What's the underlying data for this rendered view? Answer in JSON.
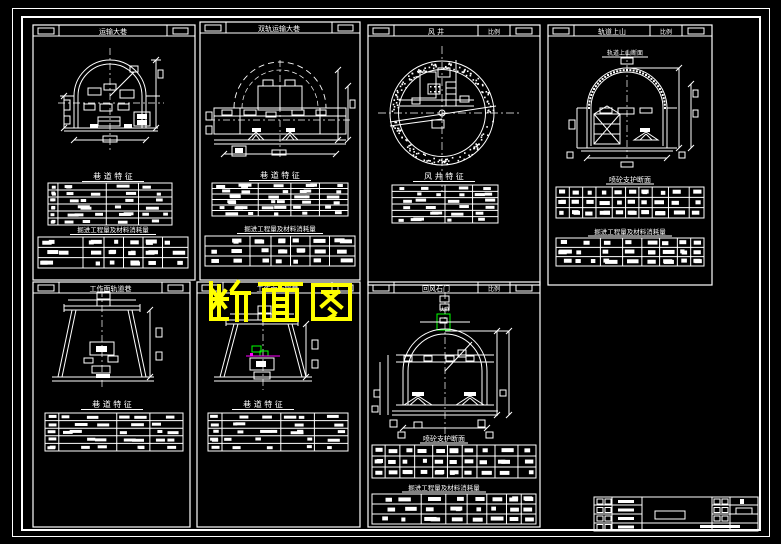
{
  "sheet": {
    "background_color": "#000000",
    "line_color": "#ffffff",
    "accent_green": "#00ff00",
    "accent_magenta": "#ff00ff"
  },
  "watermark": {
    "text": "断面图",
    "color": "#ffff00"
  },
  "panels": [
    {
      "title": "运输大巷",
      "char_table_heading": "巷 道 特 征",
      "qty_table_heading": "掘进工程量及材料消耗量"
    },
    {
      "title": "双轨运输大巷",
      "char_table_heading": "巷 道 特 征",
      "qty_table_heading": "掘进工程量及材料消耗量"
    },
    {
      "title": "风 井",
      "scale_label": "比例",
      "char_table_heading": "风 井 特 征"
    },
    {
      "title": "轨道上山",
      "scale_label": "比例",
      "section_subtitle": "轨道上山断面",
      "char_table_heading": "喷砼支护断面",
      "qty_table_heading": "掘进工程量及材料消耗量"
    },
    {
      "title": "工作面轨道巷",
      "char_table_heading": "巷 道 特 征"
    },
    {
      "title": "工作面运输巷",
      "char_table_heading": "巷 道 特 征"
    },
    {
      "title": "回风石门",
      "scale_label": "比例",
      "detail_label": "大样",
      "char_table_heading": "喷砼支护断面",
      "qty_table_heading": "掘进工程量及材料消耗量"
    }
  ]
}
